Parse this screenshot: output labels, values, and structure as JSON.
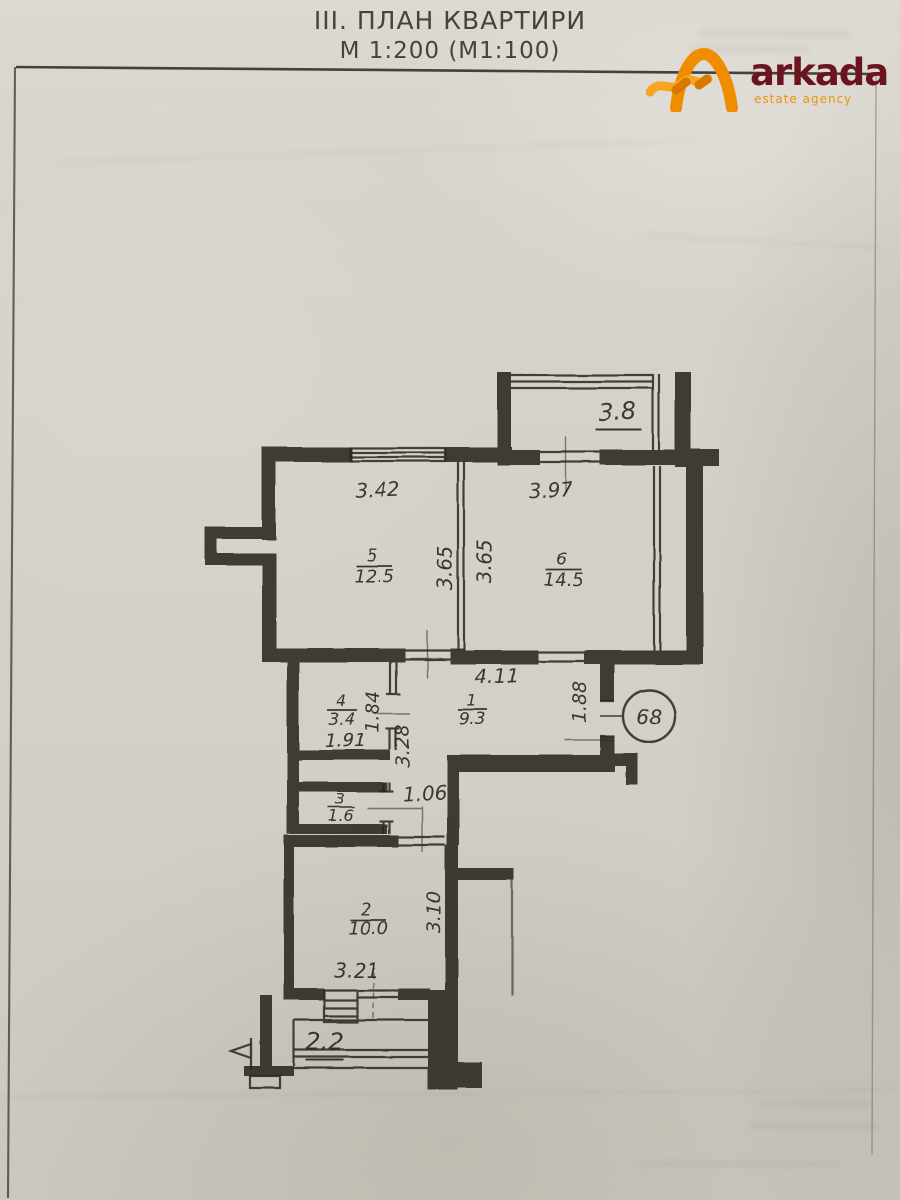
{
  "document": {
    "title": "III. ПЛАН КВАРТИРИ",
    "scale": "М 1:200 (М1:100)"
  },
  "logo": {
    "wordmark": "arkada",
    "tagline": "estate agency",
    "colors": {
      "icon_orange": "#ef8c06",
      "wordmark_maroon": "#6b1420",
      "tagline_orange": "#e9940f"
    }
  },
  "plan": {
    "apartment_number": "68",
    "rooms": {
      "r1": {
        "num": "1",
        "area": "9.3"
      },
      "r2": {
        "num": "2",
        "area": "10.0"
      },
      "r3": {
        "num": "3",
        "area": "1.6"
      },
      "r4": {
        "num": "4",
        "area": "3.4"
      },
      "r5": {
        "num": "5",
        "area": "12.5"
      },
      "r6": {
        "num": "6",
        "area": "14.5"
      }
    },
    "balconies": {
      "top": "3.8",
      "bottom": "2.2"
    },
    "dims": {
      "room5_width": "3.42",
      "room6_width": "3.97",
      "room5_depth": "3.65",
      "room6_depth": "3.65",
      "hall_length": "4.11",
      "entry_width": "1.88",
      "room4_width": "1.91",
      "room4_depth": "1.84",
      "corridor_length": "3.28",
      "corridor_width": "1.06",
      "room2_depth": "3.10",
      "room2_width": "3.21"
    },
    "ink_color": "#2b2924"
  }
}
